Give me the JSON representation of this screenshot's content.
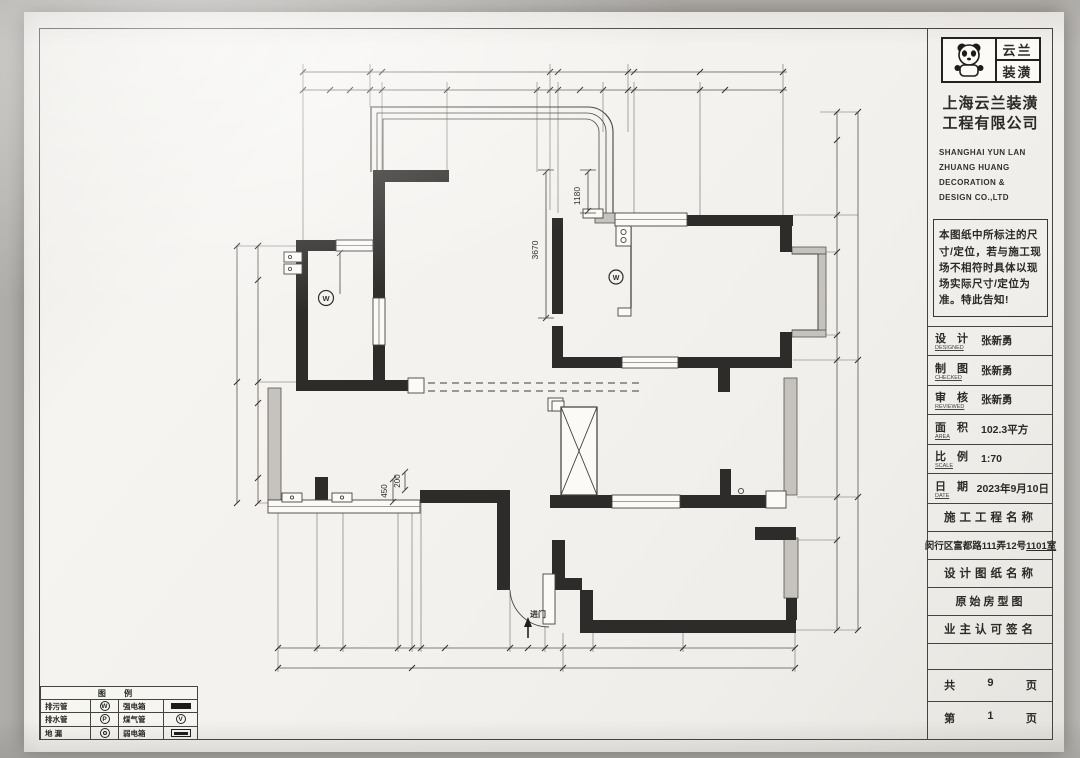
{
  "sheet": {
    "title_block": {
      "brand": {
        "mascot_icon": "panda-icon",
        "name_top": "云兰",
        "name_bottom": "装潢"
      },
      "company_cn_line1": "上海云兰装潢",
      "company_cn_line2": "工程有限公司",
      "company_en_line1": "SHANGHAI YUN LAN",
      "company_en_line2": "ZHUANG    HUANG",
      "company_en_line3": "DECORATION &",
      "company_en_line4": "DESIGN CO.,LTD",
      "notice": "本图纸中所标注的尺寸/定位，若与施工现场不相符时具体以现场实际尺寸/定位为准。特此告知!",
      "fields": [
        {
          "label": "设 计",
          "sub": "DESIGNED",
          "value": "张新勇"
        },
        {
          "label": "制 图",
          "sub": "CHECKED",
          "value": "张新勇"
        },
        {
          "label": "审 核",
          "sub": "REVIEWED",
          "value": "张新勇"
        },
        {
          "label": "面 积",
          "sub": "AREA",
          "value": "102.3平方"
        },
        {
          "label": "比 例",
          "sub": "SCALE",
          "value": "1:70"
        },
        {
          "label": "日 期",
          "sub": "DATE",
          "value": "2023年9月10日"
        }
      ],
      "project_name_header": "施工工程名称",
      "project_address_main": "闵行区富都路111弄12号",
      "project_address_room": "1101室",
      "drawing_name_header": "设计图纸名称",
      "drawing_name": "原始房型图",
      "owner_sign_header": "业主认可签名",
      "total_pages": {
        "prefix": "共",
        "value": "9",
        "suffix": "页"
      },
      "current_page": {
        "prefix": "第",
        "value": "1",
        "suffix": "页"
      }
    },
    "legend": {
      "title": "图 例",
      "rows": [
        {
          "label_a": "排污管",
          "sym_a": "W",
          "sym_a_icon": "w-circle-symbol",
          "label_b": "强电箱",
          "sym_b_icon": "solid-rect-symbol"
        },
        {
          "label_a": "排水管",
          "sym_a": "P",
          "sym_a_icon": "p-circle-symbol",
          "label_b": "煤气管",
          "sym_b": "V",
          "sym_b_icon": "v-circle-symbol"
        },
        {
          "label_a": "地 漏",
          "sym_a_icon": "double-circle-symbol",
          "label_b": "弱电箱",
          "sym_b_icon": "striped-rect-symbol"
        }
      ]
    },
    "plan": {
      "dims": {
        "window_offset": "1180",
        "room_depth": "3670",
        "door_side": "450",
        "door_width": "200"
      },
      "entrance_label": "进门",
      "fixture_w": "W"
    }
  },
  "colors": {
    "photo_background": "#bdbbb7",
    "paper": "#f4f2ee",
    "ink": "#2e2c29",
    "wall_fill": "#2d2c2a",
    "hatch_wall": "#c6c3be"
  }
}
